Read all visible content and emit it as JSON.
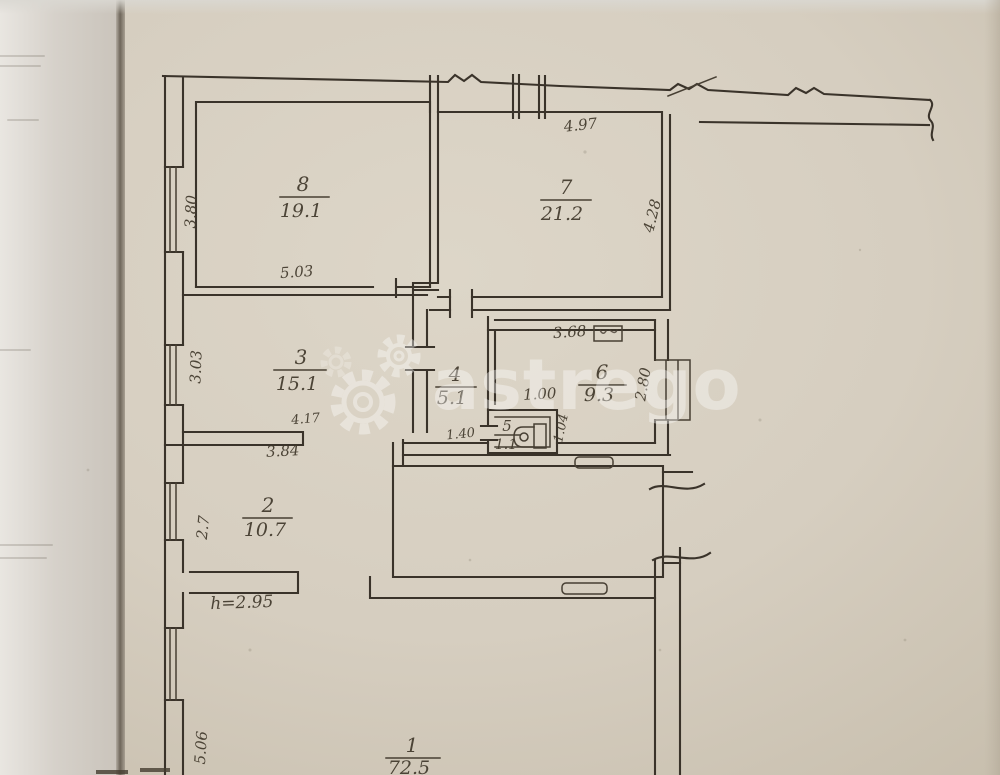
{
  "document": {
    "kind": "scanned apartment floor plan",
    "height_note": "h=2.95"
  },
  "watermark": {
    "text": "astrego",
    "color": "#ffffff"
  },
  "rooms": {
    "r8": {
      "number": "8",
      "area": "19.1"
    },
    "r7": {
      "number": "7",
      "area": "21.2"
    },
    "r3": {
      "number": "3",
      "area": "15.1"
    },
    "r4": {
      "number": "4",
      "area": "5.1"
    },
    "r5": {
      "number": "5",
      "area": "1.1"
    },
    "r6": {
      "number": "6",
      "area": "9.3"
    },
    "r2": {
      "number": "2",
      "area": "10.7"
    },
    "r1": {
      "number": "1",
      "area": "72.5"
    }
  },
  "dimensions": {
    "room8_left": "3.80",
    "room8_bottom": "5.03",
    "room7_top": "4.97",
    "room7_right": "4.28",
    "room3_left": "3.03",
    "room3_bottom_inner": "4.17",
    "room3_bottom_outer": "3.84",
    "room6_top": "3.68",
    "room6_inner": "1.00",
    "room6_right": "2.80",
    "room4_bottom": "1.40",
    "room5_right": "1.04",
    "room2_left": "2.7",
    "ceiling_height": "h=2.95",
    "room1_left": "5.06"
  },
  "colors": {
    "paper": "#d8d0c2",
    "ink": "#3a332a",
    "watermark": "#ffffff"
  }
}
